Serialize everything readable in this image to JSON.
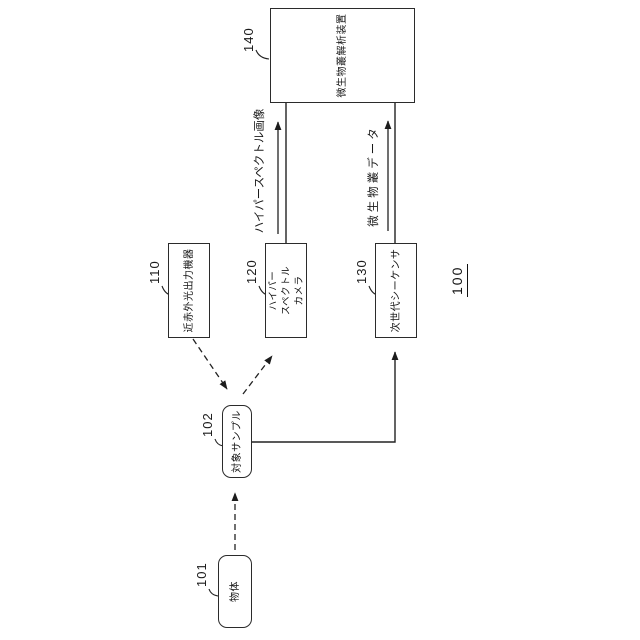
{
  "figure_number": "100",
  "nodes": {
    "object": {
      "ref": "101",
      "label": "物体"
    },
    "sample": {
      "ref": "102",
      "label": "対象サンプル"
    },
    "nir": {
      "ref": "110",
      "label": "近赤外光出力機器"
    },
    "camera": {
      "ref": "120",
      "line1": "ハイパー",
      "line2": "スペクトル",
      "line3": "カメラ"
    },
    "sequencer": {
      "ref": "130",
      "label": "次世代シーケンサ"
    },
    "analyzer": {
      "ref": "140",
      "label": "微生物叢解析装置"
    }
  },
  "flows": {
    "hyperspectral_image": "ハイパースペクトル画像",
    "microbiome_data": "微生物叢データ"
  },
  "colors": {
    "line": "#222222",
    "background": "#ffffff"
  }
}
